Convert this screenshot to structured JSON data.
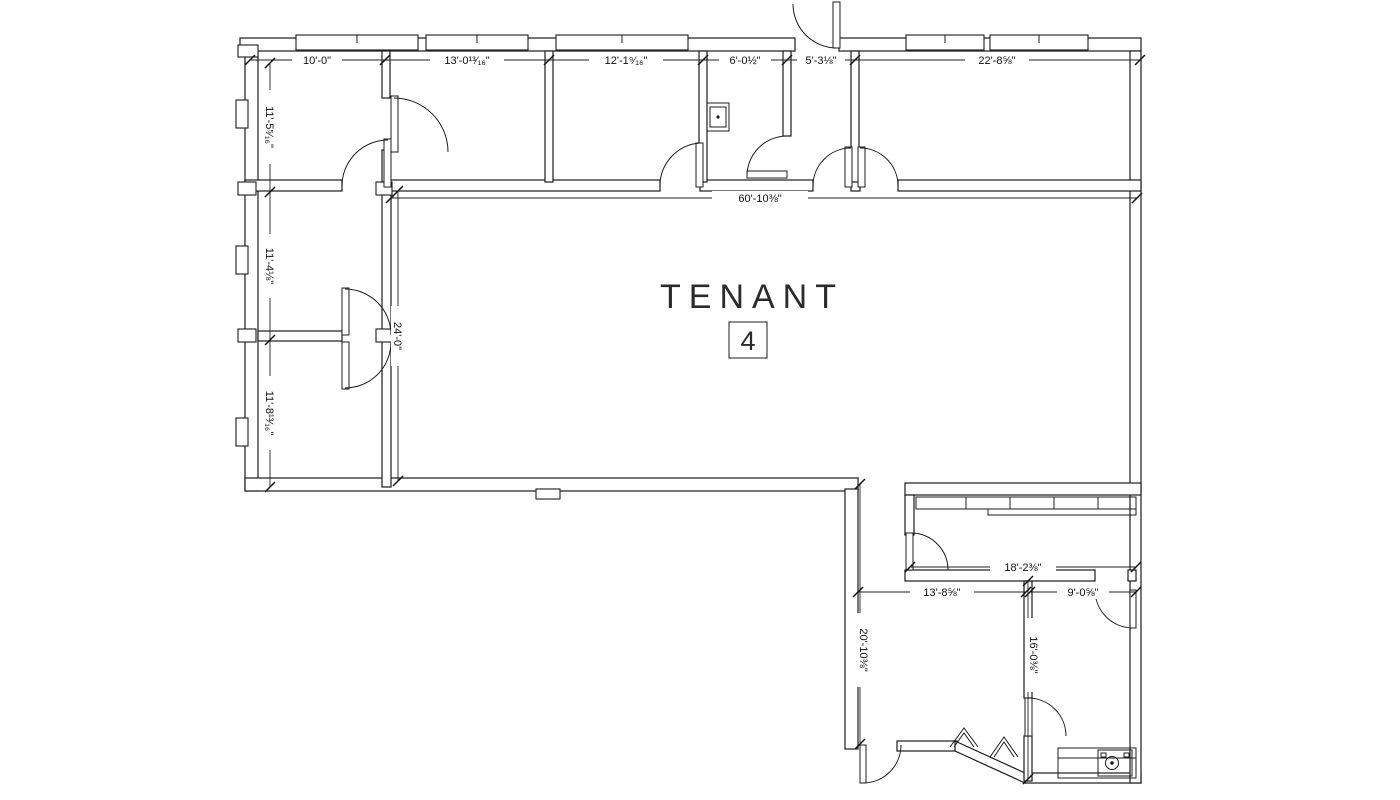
{
  "title": {
    "label": "TENANT",
    "unit": "4"
  },
  "dimensions": {
    "top": [
      "10'-0\"",
      "13'-0¹³⁄₁₆\"",
      "12'-1⁹⁄₁₆\"",
      "6'-0½\"",
      "5'-3⅛\"",
      "22'-8⅝\""
    ],
    "left": [
      "11'-5⁵⁄₁₆\"",
      "11'-4⅛\"",
      "11'-8¹³⁄₁₆\""
    ],
    "open_area_width": "60'-10⅜\"",
    "open_area_depth": "24'-0\"",
    "lower_room_top_width": "18'-2⅜\"",
    "lower_left_width": "13'-8⅝\"",
    "lower_right_width": "9'-0⅝\"",
    "corridor_depth": "20'-10⅜\"",
    "lower_room_depth": "16'-0⅜\""
  },
  "colors": {
    "line": "#1c1c1c",
    "background": "#ffffff",
    "dim_text": "#111111"
  }
}
